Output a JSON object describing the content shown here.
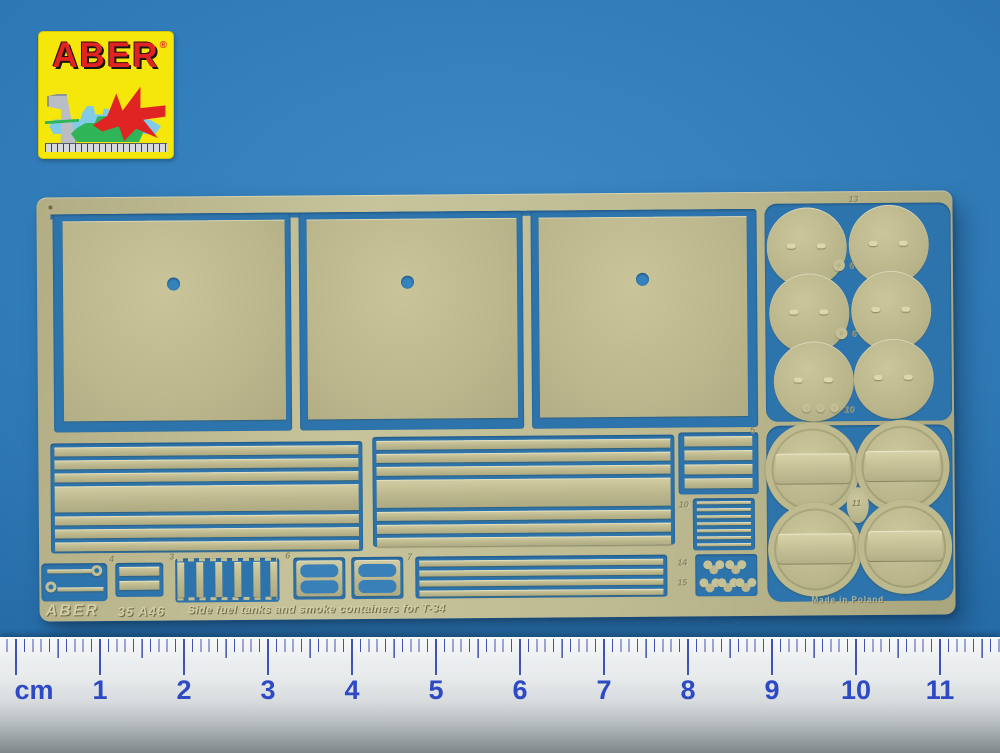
{
  "logo": {
    "brand": "ABER",
    "registered_mark": "®",
    "colors": {
      "background": "#F6E70A",
      "brand_text": "#E02424",
      "ship": "#7FCBE8",
      "jet": "#E02424",
      "tank": "#2FB457",
      "square_tool": "#B9BDC4"
    }
  },
  "fret": {
    "etched_brand": "ABER",
    "etched_code": "35 A46",
    "etched_title": "Side fuel tanks and smoke containers for T-34",
    "etched_footnote": "Made in Poland",
    "part_labels": {
      "circles_top": "13",
      "circles_row1": "6",
      "circles_row2": "6",
      "circles_row3": "10",
      "slotted_circles": "11",
      "stack": "5",
      "ladder": "10",
      "clover_a": "14",
      "clover_b": "15",
      "buckle": "4",
      "comb": "3",
      "pair_a": "6",
      "pair_b": "7"
    },
    "colors": {
      "brass": "#BDB88E",
      "cutout_blue": "#2E74AC"
    }
  },
  "ruler": {
    "unit_label": "cm",
    "numbers": [
      "1",
      "2",
      "3",
      "4",
      "5",
      "6",
      "7",
      "8",
      "9",
      "10",
      "11"
    ],
    "colors": {
      "ticks": "#4152B0",
      "numbers": "#2D49C4"
    }
  },
  "background": {
    "color": "#2E7AB8"
  }
}
